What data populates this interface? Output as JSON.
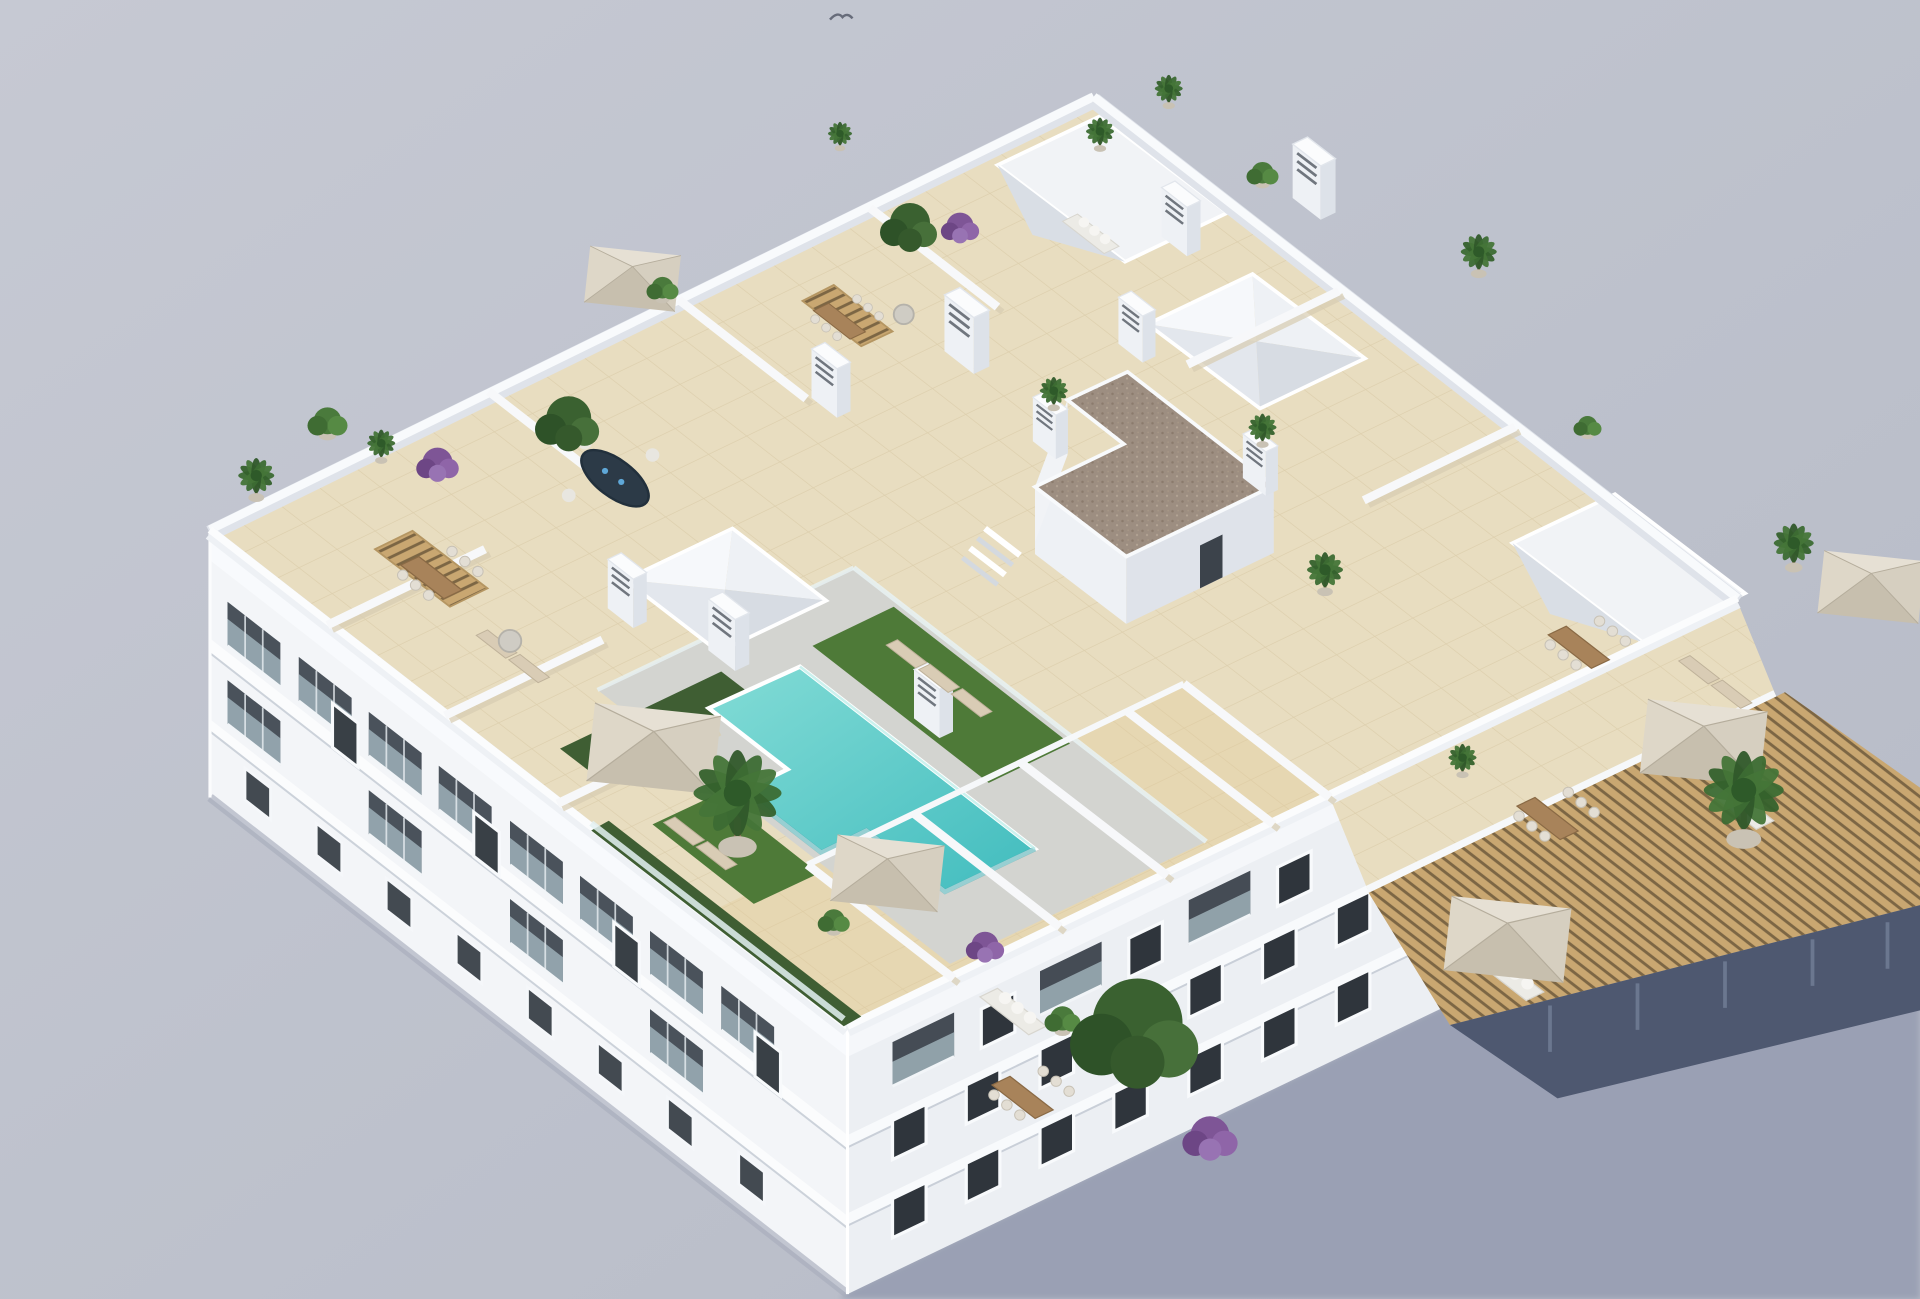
{
  "scene": {
    "title": "Aerial 3D render of a white apartment building rooftop with communal T-shaped pool, private tiled terraces, parasols and plants",
    "background_color": "#bdc1cc",
    "shadow_color": "#9aa0b4",
    "palette": {
      "wall_white": "#f3f5f8",
      "wall_shade": "#dfe3ea",
      "roof_tile": "#e8ddc0",
      "tile_line": "#d9cba8",
      "pool_water": "#5fcfcb",
      "pool_deck": "#d3d4d0",
      "grass": "#4e7a38",
      "gravel_roof": "#9d8e81",
      "parasol": "#d8d1c2",
      "wood": "#a8835a",
      "pergola_slats": "#c9a771",
      "bougainvillea": "#8a5d9e",
      "glass": "#a9bdc6"
    },
    "objects": {
      "building_floors_visible": 3,
      "rooftop_pool": {
        "shape": "T-shaped",
        "color": "#5fcfcb"
      },
      "parasols": 6,
      "pyramid_skylights": 2,
      "sunken_patios": 2,
      "chimneys": 10,
      "grass_patches": 3,
      "hedges": 2,
      "sun_loungers": 9,
      "dining_sets": 5,
      "outdoor_sofas": 4,
      "pergolas": 3,
      "palm_plants": 13,
      "green_shrubs": 7,
      "purple_shrubs": 4,
      "trees": 3,
      "stair_core_gravel_roof": true,
      "bird_in_sky": true
    }
  }
}
